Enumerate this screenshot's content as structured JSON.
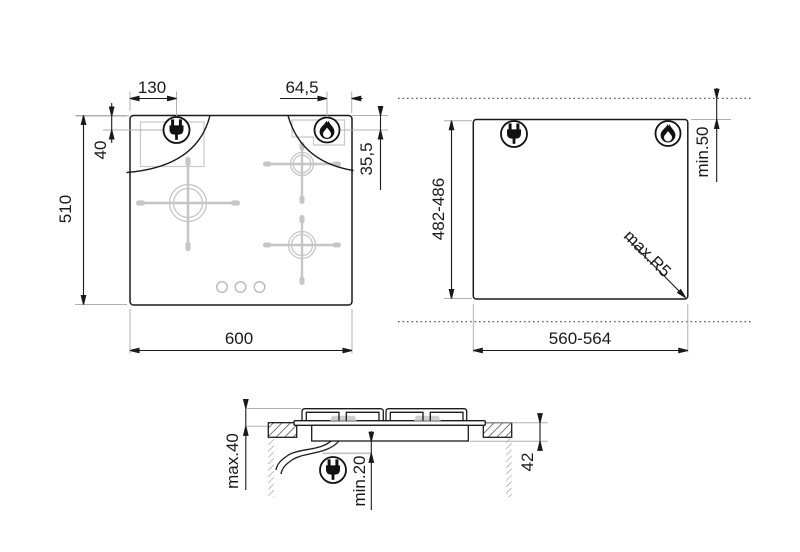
{
  "drawing": {
    "type": "hob-installation-diagram",
    "views": [
      "hob-top-view",
      "worktop-cutout-view",
      "side-section-view"
    ]
  },
  "labels": {
    "top_plug_offset_x": "130",
    "top_flame_offset_x": "64,5",
    "top_plug_offset_y": "40",
    "top_flame_offset_y": "35,5",
    "top_depth": "510",
    "top_width": "600",
    "cutout_height": "482-486",
    "cutout_width": "560-564",
    "cutout_rear_clearance": "min.50",
    "cutout_corner_radius": "max.R5",
    "side_height_above": "max.40",
    "side_clearance_below": "min.20",
    "side_recess_depth": "42"
  },
  "icons": {
    "plug": "power-plug-icon",
    "flame": "gas-flame-icon"
  },
  "colors": {
    "line": "#1a1a1a",
    "extension_gray": "#b0b0b0",
    "detail_gray": "#c8c8c8",
    "background": "#ffffff"
  }
}
